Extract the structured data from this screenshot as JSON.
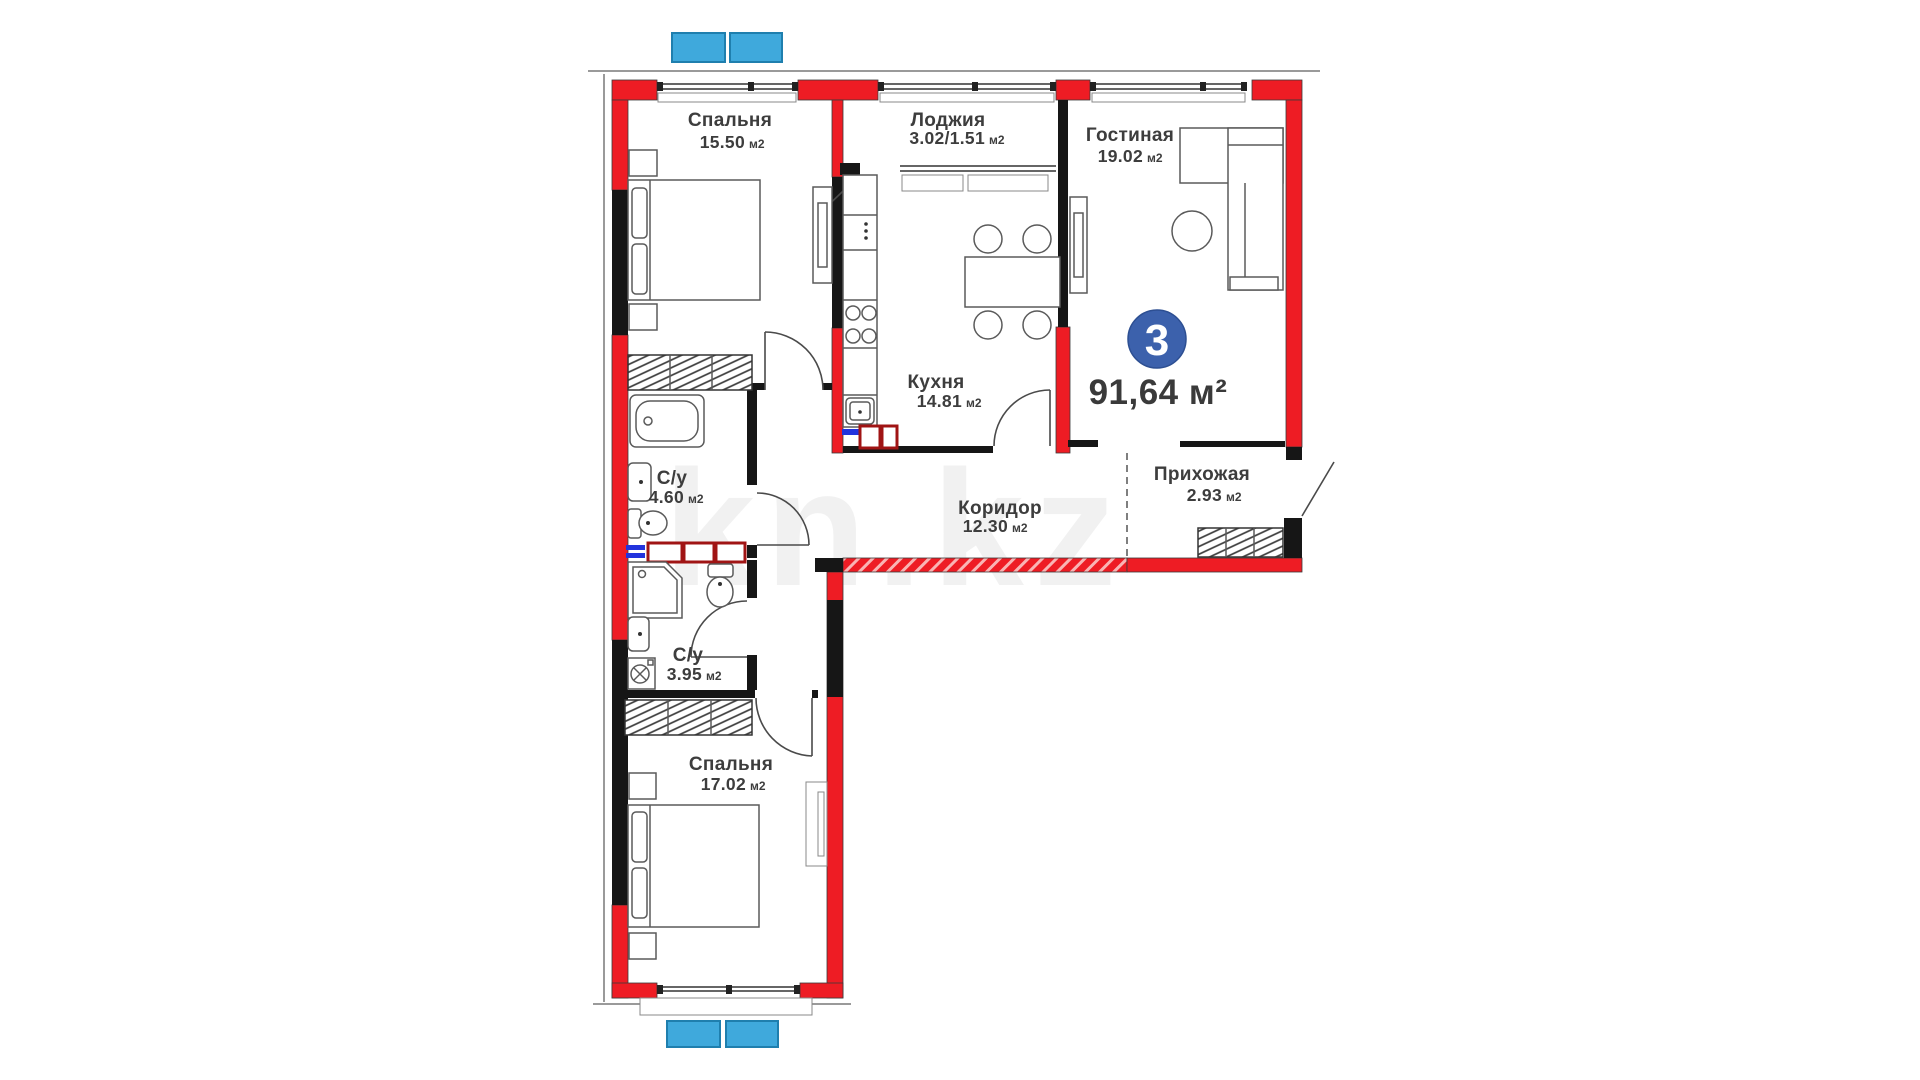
{
  "plan": {
    "type_badge": "3",
    "total_area": "91,64 м²",
    "watermark": "kn.kz",
    "rooms": [
      {
        "name": "Спальня",
        "area": "15.50",
        "unit": "м2"
      },
      {
        "name": "Лоджия",
        "area": "3.02/1.51",
        "unit": "м2"
      },
      {
        "name": "Гостиная",
        "area": "19.02",
        "unit": "м2"
      },
      {
        "name": "Кухня",
        "area": "14.81",
        "unit": "м2"
      },
      {
        "name": "С/у",
        "area": "4.60",
        "unit": "м2"
      },
      {
        "name": "Коридор",
        "area": "12.30",
        "unit": "м2"
      },
      {
        "name": "Прихожая",
        "area": "2.93",
        "unit": "м2"
      },
      {
        "name": "С/у",
        "area": "3.95",
        "unit": "м2"
      },
      {
        "name": "Спальня",
        "area": "17.02",
        "unit": "м2"
      }
    ],
    "colors": {
      "wall_red": "#ee1c24",
      "window_marker_blue": "#3fa9dc",
      "badge_blue": "#3c61ac",
      "vent_blue": "#2233dd",
      "shaft_maroon": "#a01414"
    }
  }
}
